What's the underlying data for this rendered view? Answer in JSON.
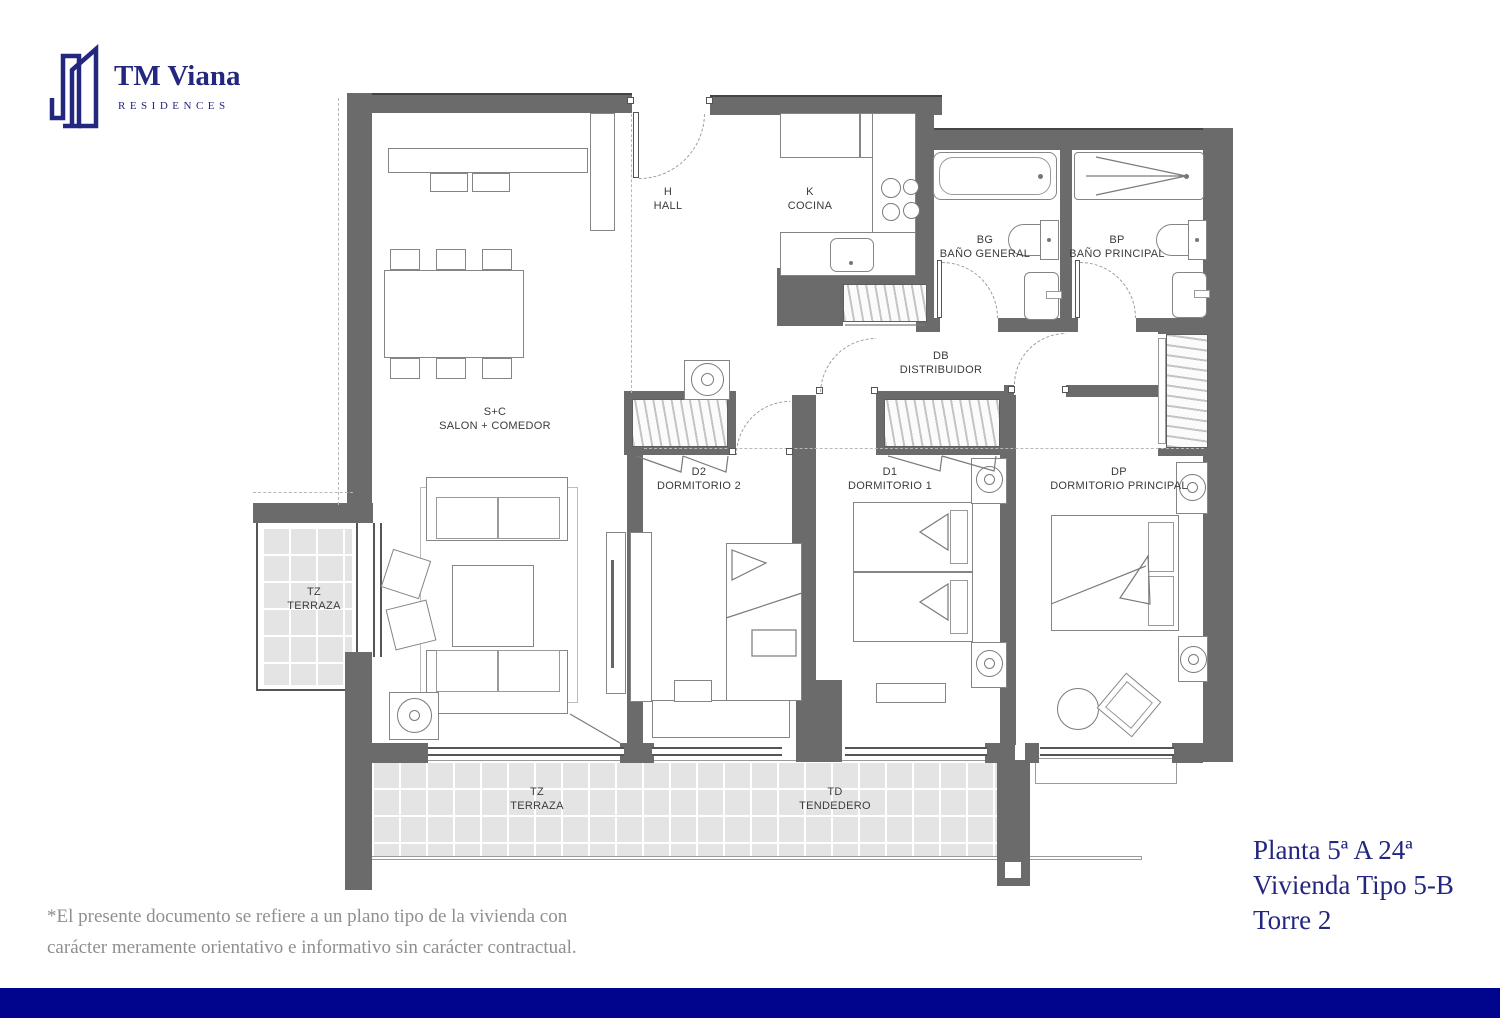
{
  "brand": {
    "name": "TM Viana",
    "tagline": "RESIDENCES"
  },
  "rooms": [
    {
      "code": "H",
      "name": "HALL"
    },
    {
      "code": "K",
      "name": "COCINA"
    },
    {
      "code": "BG",
      "name": "BAÑO GENERAL"
    },
    {
      "code": "BP",
      "name": "BAÑO PRINCIPAL"
    },
    {
      "code": "DB",
      "name": "DISTRIBUIDOR"
    },
    {
      "code": "S+C",
      "name": "SALON + COMEDOR"
    },
    {
      "code": "D2",
      "name": "DORMITORIO 2"
    },
    {
      "code": "D1",
      "name": "DORMITORIO 1"
    },
    {
      "code": "DP",
      "name": "DORMITORIO PRINCIPAL"
    },
    {
      "code": "TZ",
      "name": "TERRAZA"
    },
    {
      "code": "TZ",
      "name": "TERRAZA"
    },
    {
      "code": "TD",
      "name": "TENDEDERO"
    }
  ],
  "title_block": {
    "floor": "Planta 5ª A 24ª",
    "unit": "Vivienda Tipo 5-B",
    "tower": "Torre 2"
  },
  "disclaimer": "*El presente documento se refiere a un plano tipo de la vivienda con carácter meramente orientativo e informativo sin carácter contractual.",
  "colors": {
    "navy": "#23277f",
    "bar": "#01048c",
    "wall": "#6b6b6b"
  }
}
